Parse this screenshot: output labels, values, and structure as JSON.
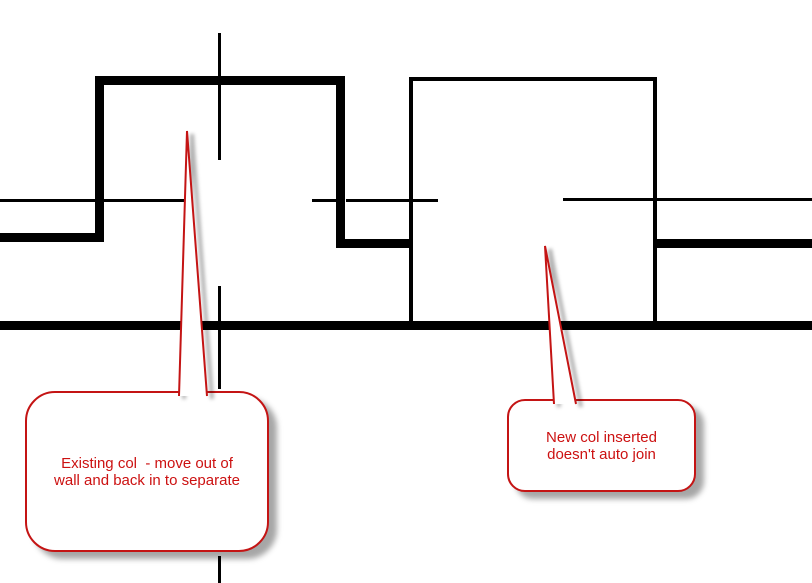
{
  "canvas": {
    "width": 812,
    "height": 583,
    "background": "#ffffff"
  },
  "colors": {
    "wall_line": "#000000",
    "annotation_red": "#c41414",
    "callout_text_red": "#cc1111",
    "callout_fill": "#ffffff",
    "shadow": "rgba(0,0,0,0.35)"
  },
  "drawing": {
    "segments": [
      {
        "name": "wall-top-edge-left",
        "x": 0,
        "y": 199,
        "w": 95,
        "h": 3
      },
      {
        "name": "wall-top-edge-inside-existing-col",
        "x": 104,
        "y": 199,
        "w": 82,
        "h": 3
      },
      {
        "name": "wall-top-edge-tick",
        "x": 312,
        "y": 199,
        "w": 25,
        "h": 3
      },
      {
        "name": "wall-top-edge-mid",
        "x": 346,
        "y": 199,
        "w": 92,
        "h": 3
      },
      {
        "name": "wall-top-edge-right",
        "x": 563,
        "y": 198,
        "w": 249,
        "h": 3
      },
      {
        "name": "wall-bottom-edge-left",
        "x": 0,
        "y": 233,
        "w": 100,
        "h": 9
      },
      {
        "name": "wall-bottom-edge-mid",
        "x": 337,
        "y": 239,
        "w": 74,
        "h": 9
      },
      {
        "name": "wall-bottom-edge-right",
        "x": 653,
        "y": 239,
        "w": 159,
        "h": 9
      },
      {
        "name": "lower-wall-edge",
        "x": 0,
        "y": 321,
        "w": 812,
        "h": 9
      },
      {
        "name": "existing-col-top-edge",
        "x": 95,
        "y": 76,
        "w": 250,
        "h": 9
      },
      {
        "name": "existing-col-left-edge",
        "x": 95,
        "y": 76,
        "w": 9,
        "h": 166
      },
      {
        "name": "existing-col-right-edge",
        "x": 336,
        "y": 76,
        "w": 9,
        "h": 172
      },
      {
        "name": "new-col-top-edge",
        "x": 409,
        "y": 77,
        "w": 248,
        "h": 4
      },
      {
        "name": "new-col-left-edge",
        "x": 409,
        "y": 77,
        "w": 4,
        "h": 248
      },
      {
        "name": "new-col-right-edge",
        "x": 653,
        "y": 77,
        "w": 4,
        "h": 248
      },
      {
        "name": "column-centerline-upper",
        "x": 218,
        "y": 33,
        "w": 3,
        "h": 127
      },
      {
        "name": "column-centerline-middle",
        "x": 218,
        "y": 286,
        "w": 3,
        "h": 103
      },
      {
        "name": "column-centerline-lower",
        "x": 218,
        "y": 556,
        "w": 3,
        "h": 27
      }
    ]
  },
  "callouts": [
    {
      "name": "callout-existing-col",
      "lines": [
        "Existing col  - move out of",
        "wall and back in to separate"
      ],
      "bubble": {
        "x": 25,
        "y": 391,
        "w": 244,
        "h": 161,
        "r": 30
      },
      "tail": {
        "apex_x": 187,
        "apex_y": 131,
        "base_x1": 179,
        "base_x2": 207,
        "base_y": 396
      }
    },
    {
      "name": "callout-new-col",
      "lines": [
        "New col inserted",
        "doesn't auto join"
      ],
      "bubble": {
        "x": 507,
        "y": 399,
        "w": 189,
        "h": 93,
        "r": 18
      },
      "tail": {
        "apex_x": 545,
        "apex_y": 246,
        "base_x1": 554,
        "base_x2": 576,
        "base_y": 404
      }
    }
  ]
}
